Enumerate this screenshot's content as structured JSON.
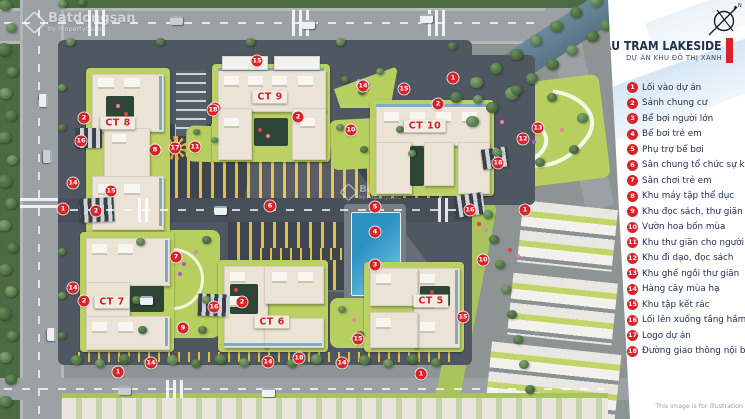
{
  "panel": {
    "title": "BAU TRAM LAKESIDE",
    "subtitle": "DỰ ÁN KHU ĐÔ THỊ XANH",
    "footnote": "This image is for illustration",
    "compass_label": "N",
    "legend": [
      {
        "num": "1",
        "label": "Lối vào dự án"
      },
      {
        "num": "2",
        "label": "Sảnh chung cư"
      },
      {
        "num": "3",
        "label": "Bể bơi người lớn"
      },
      {
        "num": "4",
        "label": "Bể bơi trẻ em"
      },
      {
        "num": "5",
        "label": "Phụ trợ bể bơi"
      },
      {
        "num": "6",
        "label": "Sân chung tổ chức sự kiện"
      },
      {
        "num": "7",
        "label": "Sân chơi trẻ em"
      },
      {
        "num": "8",
        "label": "Khu máy tập thể dục"
      },
      {
        "num": "9",
        "label": "Khu đọc sách, thư giãn"
      },
      {
        "num": "10",
        "label": "Vườn hoa bốn mùa"
      },
      {
        "num": "11",
        "label": "Khu thư giãn cho người già"
      },
      {
        "num": "12",
        "label": "Khu đi dạo, đọc sách"
      },
      {
        "num": "13",
        "label": "Khu ghế ngồi thư giãn"
      },
      {
        "num": "14",
        "label": "Hàng cây mùa hạ"
      },
      {
        "num": "15",
        "label": "Khu tập kết rác"
      },
      {
        "num": "16",
        "label": "Lối lên xuống tầng hầm"
      },
      {
        "num": "17",
        "label": "Logo dự án"
      },
      {
        "num": "18",
        "label": "Đường giao thông nội bộ"
      }
    ],
    "accent_color": "#d8232a",
    "title_color": "#20304f"
  },
  "map": {
    "watermark": {
      "brand": "Batdongsan",
      "byline": "by PropertyGuru"
    },
    "buildings": [
      {
        "label": "CT 8",
        "x": 118,
        "y": 123
      },
      {
        "label": "CT 9",
        "x": 270,
        "y": 97
      },
      {
        "label": "CT 10",
        "x": 425,
        "y": 126
      },
      {
        "label": "CT 7",
        "x": 112,
        "y": 302
      },
      {
        "label": "CT 6",
        "x": 272,
        "y": 322
      },
      {
        "label": "CT 5",
        "x": 431,
        "y": 301
      }
    ],
    "markers": [
      {
        "n": "1",
        "x": 63,
        "y": 209
      },
      {
        "n": "1",
        "x": 118,
        "y": 372
      },
      {
        "n": "1",
        "x": 421,
        "y": 374
      },
      {
        "n": "1",
        "x": 525,
        "y": 210
      },
      {
        "n": "1",
        "x": 453,
        "y": 78
      },
      {
        "n": "2",
        "x": 84,
        "y": 118
      },
      {
        "n": "2",
        "x": 96,
        "y": 211
      },
      {
        "n": "2",
        "x": 84,
        "y": 301
      },
      {
        "n": "2",
        "x": 242,
        "y": 302
      },
      {
        "n": "2",
        "x": 438,
        "y": 104
      },
      {
        "n": "2",
        "x": 298,
        "y": 117
      },
      {
        "n": "3",
        "x": 375,
        "y": 265
      },
      {
        "n": "4",
        "x": 375,
        "y": 232
      },
      {
        "n": "5",
        "x": 375,
        "y": 207
      },
      {
        "n": "6",
        "x": 270,
        "y": 206
      },
      {
        "n": "7",
        "x": 176,
        "y": 257
      },
      {
        "n": "8",
        "x": 155,
        "y": 150
      },
      {
        "n": "9",
        "x": 183,
        "y": 328
      },
      {
        "n": "10",
        "x": 215,
        "y": 108
      },
      {
        "n": "10",
        "x": 351,
        "y": 130
      },
      {
        "n": "10",
        "x": 483,
        "y": 260
      },
      {
        "n": "11",
        "x": 195,
        "y": 147
      },
      {
        "n": "12",
        "x": 523,
        "y": 139
      },
      {
        "n": "13",
        "x": 538,
        "y": 128
      },
      {
        "n": "14",
        "x": 73,
        "y": 183
      },
      {
        "n": "14",
        "x": 73,
        "y": 288
      },
      {
        "n": "14",
        "x": 151,
        "y": 363
      },
      {
        "n": "14",
        "x": 268,
        "y": 362
      },
      {
        "n": "14",
        "x": 342,
        "y": 363
      },
      {
        "n": "14",
        "x": 363,
        "y": 86
      },
      {
        "n": "15",
        "x": 111,
        "y": 191
      },
      {
        "n": "15",
        "x": 257,
        "y": 61
      },
      {
        "n": "15",
        "x": 404,
        "y": 89
      },
      {
        "n": "15",
        "x": 358,
        "y": 339
      },
      {
        "n": "15",
        "x": 463,
        "y": 317
      },
      {
        "n": "16",
        "x": 81,
        "y": 141
      },
      {
        "n": "16",
        "x": 214,
        "y": 307
      },
      {
        "n": "16",
        "x": 498,
        "y": 163
      },
      {
        "n": "16",
        "x": 470,
        "y": 210
      },
      {
        "n": "17",
        "x": 175,
        "y": 148
      },
      {
        "n": "18",
        "x": 213,
        "y": 110
      },
      {
        "n": "18",
        "x": 299,
        "y": 358
      }
    ]
  }
}
